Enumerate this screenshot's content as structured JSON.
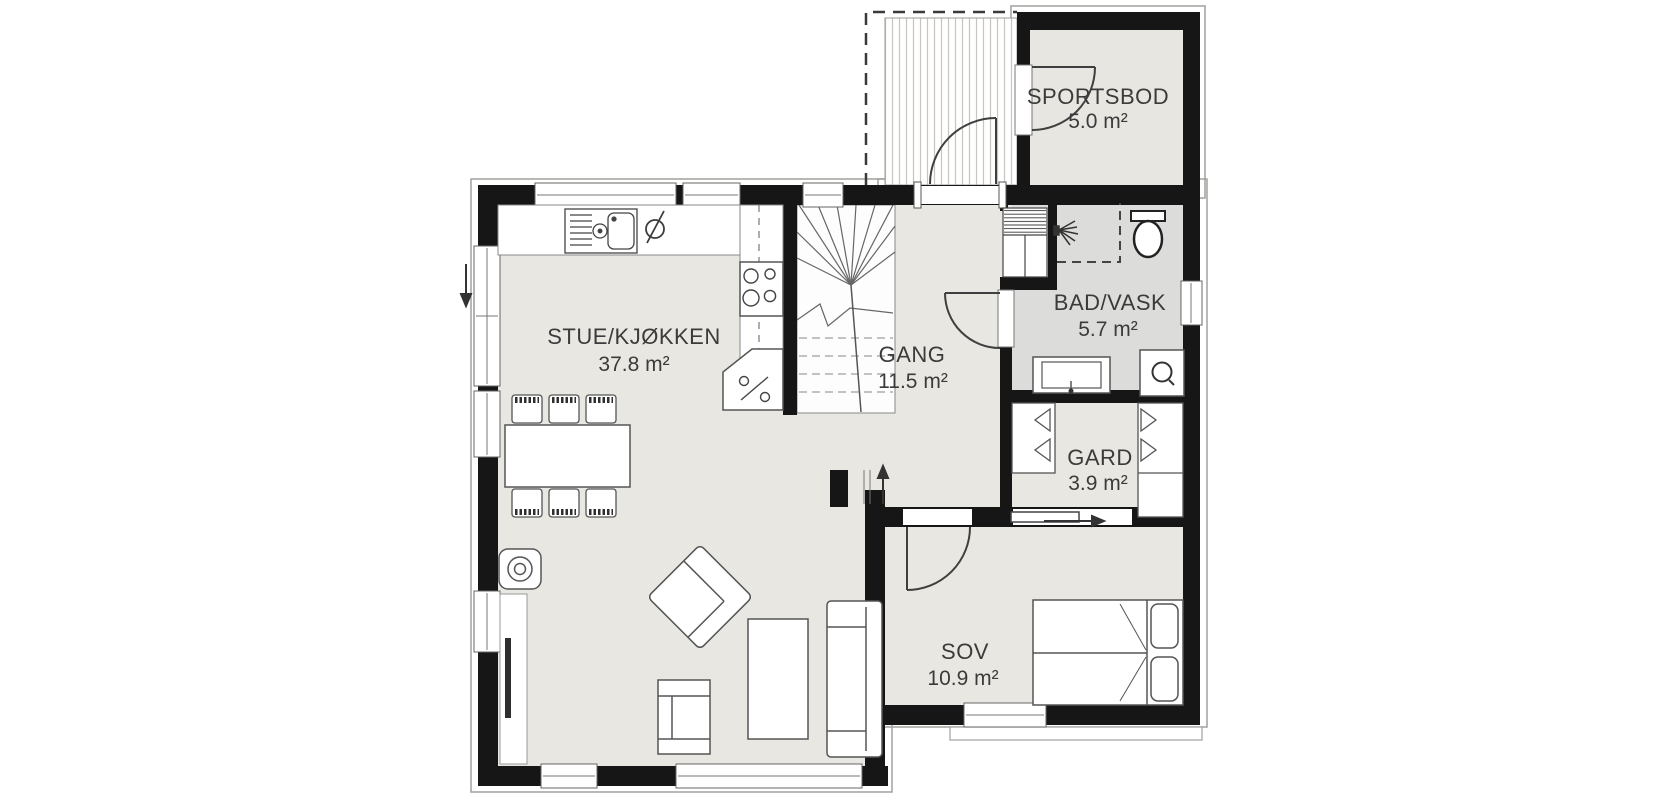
{
  "rooms": [
    {
      "name": "STUE/KJØKKEN",
      "area": "37.8 m²"
    },
    {
      "name": "GANG",
      "area": "11.5 m²"
    },
    {
      "name": "BAD/VASK",
      "area": "5.7 m²"
    },
    {
      "name": "GARD",
      "area": "3.9 m²"
    },
    {
      "name": "SOV",
      "area": "10.9 m²"
    },
    {
      "name": "SPORTSBOD",
      "area": "5.0 m²"
    }
  ],
  "fixtures": {
    "kitchen": [
      "sink",
      "faucet",
      "dishwasher-icon",
      "cooktop",
      "corner-cabinet"
    ],
    "living": [
      "dining-table",
      "dining-chairs",
      "wood-stove",
      "tv",
      "tv-bench",
      "armchair",
      "lounge-chair",
      "coffee-table",
      "sofa"
    ],
    "bathroom": [
      "shower",
      "shower-head-icon",
      "toilet",
      "vanity-sink",
      "washing-machine",
      "tech-cabinet"
    ],
    "wardrobe": [
      "closet-left",
      "closet-right",
      "sliding-door"
    ],
    "bedroom": [
      "double-bed",
      "pillows"
    ],
    "circulation": [
      "staircase",
      "entrance-door",
      "storage-door",
      "bathroom-door",
      "bedroom-door",
      "direction-arrows"
    ],
    "outdoor": [
      "entry-porch-decking",
      "roof-overhang-dashed",
      "terrace-step"
    ]
  },
  "colors": {
    "wall": "#161616",
    "floor_main": "#e9e7e1",
    "floor_bath": "#dcdcda",
    "floor_storage": "#e7e6e1",
    "line": "#555555",
    "label": "#3b3b3b"
  }
}
